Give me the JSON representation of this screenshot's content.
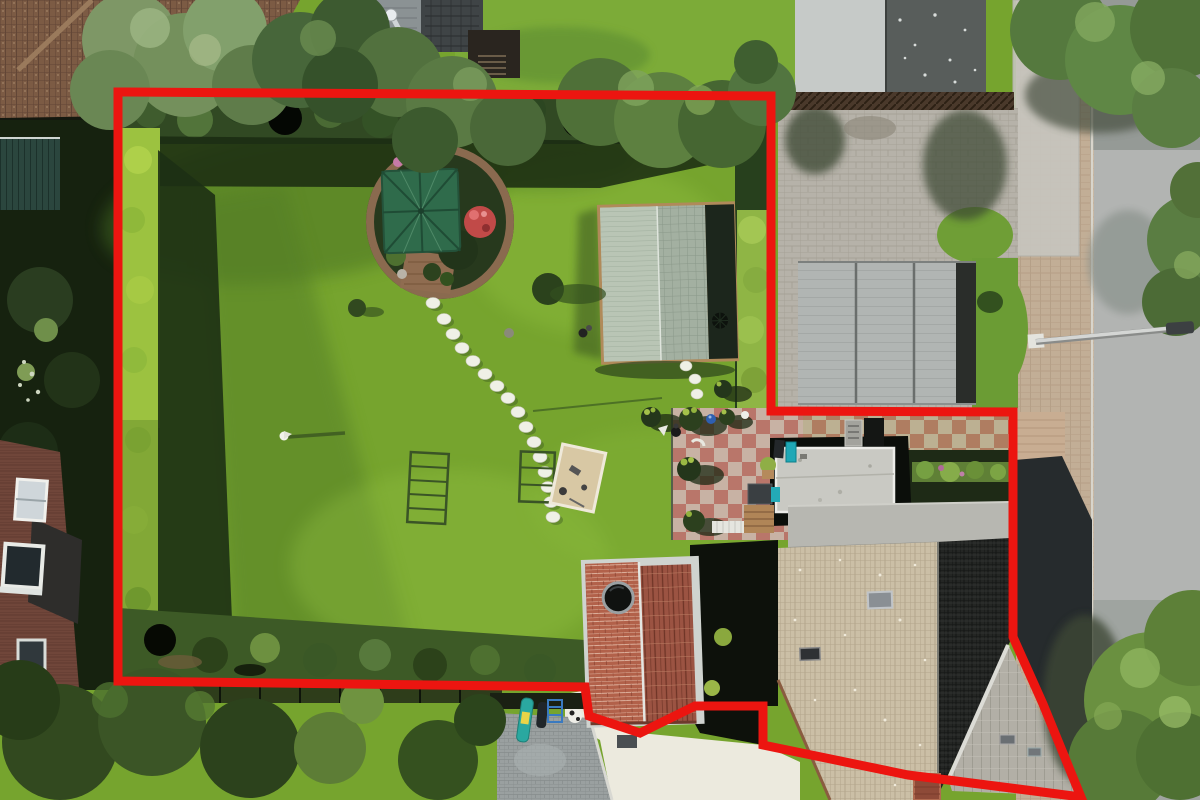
{
  "image": {
    "width": 1200,
    "height": 800,
    "alt": "Aerial drone photo of a residential garden plot outlined with a thick red property boundary line"
  },
  "boundary": {
    "points": "118,92 771,96 771,411 1013,412 1013,637 1043,704 1081,797 948,780 908,775 763,745 763,706 695,706 640,733 589,716 585,687 118,681",
    "color": "#ec1510",
    "width": 9
  },
  "colors": {
    "lawn": "#76a42e",
    "lawn_light": "#8fbe3e",
    "lawn_shadow": "#4f7a24",
    "hedge_dark": "#314923",
    "hedge_bright": "#9cc240",
    "street": "#b2b4b2",
    "sidewalk": "#c2ae96",
    "driveway": "#b6b2a9",
    "concrete": "#e9e6da",
    "roof_brown": "#7c5b44",
    "roof_beige": "#cbbfa6",
    "roof_dark": "#242624",
    "roof_gable": "#b2afa6",
    "brick_red": "#b2614a",
    "parasol_green": "#2f6b4b",
    "shed_green": "#b9c5b5",
    "patio_pink": "#b9766a",
    "flower_red": "#c14a48"
  },
  "objects": [
    {
      "name": "property-boundary",
      "type": "annotation",
      "color": "#ec1510"
    },
    {
      "name": "main-lawn"
    },
    {
      "name": "gazebo-island"
    },
    {
      "name": "gazebo-parasol",
      "color": "#2f6b4b"
    },
    {
      "name": "red-flower-bush",
      "color": "#c14a48"
    },
    {
      "name": "garden-shed",
      "color": "#b9c5b5"
    },
    {
      "name": "stepping-stones",
      "count": 19
    },
    {
      "name": "clothes-drying-racks",
      "count": 2
    },
    {
      "name": "sandbox"
    },
    {
      "name": "patio-paving",
      "color": "#b9766a"
    },
    {
      "name": "topiary-bushes",
      "count": 7
    },
    {
      "name": "extension-flat-roof"
    },
    {
      "name": "main-house-roof",
      "colors": [
        "#cbbfa6",
        "#242624",
        "#b2afa6"
      ]
    },
    {
      "name": "brick-outbuilding",
      "color": "#b2614a"
    },
    {
      "name": "garage-roofs",
      "count": 2
    },
    {
      "name": "paved-driveway"
    },
    {
      "name": "sidewalk"
    },
    {
      "name": "street"
    },
    {
      "name": "street-lamp"
    },
    {
      "name": "hedges"
    },
    {
      "name": "tree-canopies"
    },
    {
      "name": "left-neighbor-house"
    },
    {
      "name": "top-neighbor-cabin"
    }
  ]
}
